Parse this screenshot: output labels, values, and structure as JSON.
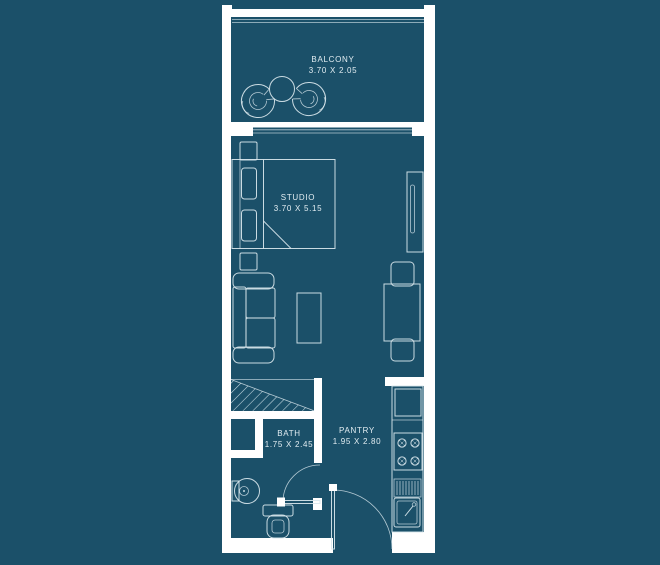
{
  "colors": {
    "background": "#1B5069",
    "walls": "#FFFFFF",
    "furniture_lines": "#D9E7ED",
    "text": "#E2EDF2"
  },
  "rooms": {
    "balcony": {
      "name": "BALCONY",
      "dimensions": "3.70 X 2.05"
    },
    "studio": {
      "name": "STUDIO",
      "dimensions": "3.70 X 5.15"
    },
    "bath": {
      "name": "BATH",
      "dimensions": "1.75 X 2.45"
    },
    "pantry": {
      "name": "PANTRY",
      "dimensions": "1.95 X 2.80"
    }
  },
  "fixtures": [
    "balcony papasan chair (left)",
    "balcony papasan chair (right)",
    "balcony round table",
    "sliding balcony door",
    "double bed",
    "pillows",
    "nightstand (top)",
    "nightstand (bottom)",
    "wardrobe",
    "sofa",
    "coffee table",
    "dining table",
    "dining chairs (2)",
    "hatched service shaft",
    "refrigerator",
    "4-burner stove",
    "drainboard",
    "kitchen sink",
    "wash basin",
    "toilet",
    "bath swing door",
    "entrance swing door"
  ]
}
